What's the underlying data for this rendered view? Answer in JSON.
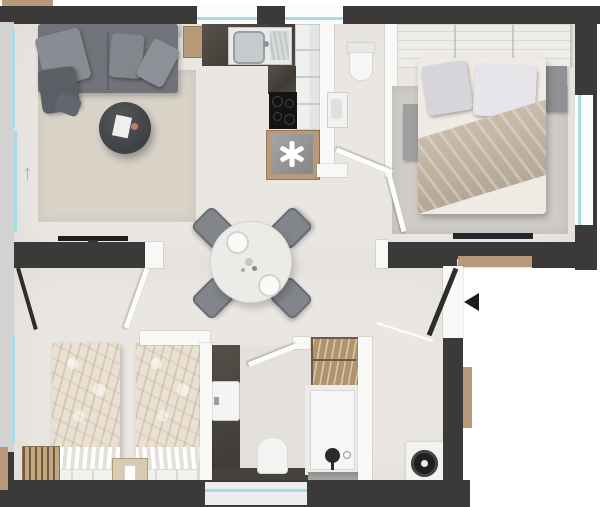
{
  "app": {
    "name": "apartment-floor-plan"
  },
  "glyphs": {
    "north_arrow": "↑",
    "entrance_arrow": "◀",
    "fridge_symbol": "✱"
  },
  "colors": {
    "wall": "#3b3a39",
    "exterior_wall_light": "#d2d2d2",
    "interior_partition": "#f8f8f7",
    "window_glass": "#a9dbe7",
    "wood_accent": "#b8997a",
    "floor": "#eae7e3",
    "kitchen_counter": "#49453e",
    "outside": "#ffffff"
  },
  "rooms": {
    "living_room": [
      "sofa",
      "cushions",
      "throw-blanket",
      "coffee-table",
      "rug",
      "tv",
      "side-table",
      "wall-shelf"
    ],
    "kitchen": [
      "countertop",
      "sink",
      "faucet",
      "drainboard",
      "cooktop",
      "fridge-freezer",
      "tall-cabinets"
    ],
    "wc": [
      "wall-hung-toilet",
      "washbasin"
    ],
    "bedroom_double": [
      "wardrobe",
      "double-bed",
      "pillows",
      "throw-blanket",
      "rug",
      "nightstand-left",
      "nightstand-right",
      "tv"
    ],
    "bedroom_twin": [
      "twin-bed-left",
      "twin-bed-right",
      "nightstand",
      "radiator"
    ],
    "bathroom": [
      "vanity-counter",
      "washbasin",
      "toilet",
      "shower",
      "towel-shelf"
    ],
    "hall": [
      "round-dining-table",
      "chairs",
      "plates",
      "entrance-door",
      "washing-machine"
    ]
  }
}
